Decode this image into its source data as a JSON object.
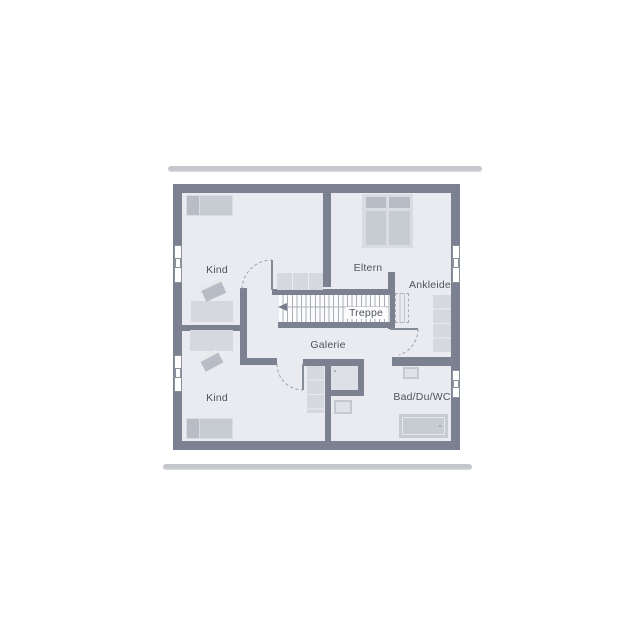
{
  "rooms": [
    {
      "id": "kind-top",
      "label": "Kind"
    },
    {
      "id": "eltern",
      "label": "Eltern"
    },
    {
      "id": "ankleide",
      "label": "Ankleide"
    },
    {
      "id": "treppe",
      "label": "Treppe"
    },
    {
      "id": "galerie",
      "label": "Galerie"
    },
    {
      "id": "kind-bottom",
      "label": "Kind"
    },
    {
      "id": "bad-du-wc",
      "label": "Bad/Du/WC"
    }
  ],
  "furniture": [
    "bed",
    "double-bed",
    "wardrobe",
    "sideboard",
    "dresser",
    "desk-chair",
    "stairs",
    "bathtub",
    "washbasin",
    "shower"
  ],
  "colors": {
    "wall": "#7b8190",
    "floor": "#e9ebf0",
    "furniture_frame": "#d9dce2",
    "furniture_light": "#d5d8de",
    "furniture_mid": "#c7cbd2",
    "furniture_dark": "#b7bcc5",
    "stair_tread": "#a9aeb8",
    "stair_bg": "#fcfcfd",
    "dash": "#9aa0ab",
    "door_leaf": "#868c97",
    "text": "#4e545e",
    "bar": "#c4c7cc",
    "window_frame": "#8a919b",
    "shower": "#dde0e6"
  }
}
